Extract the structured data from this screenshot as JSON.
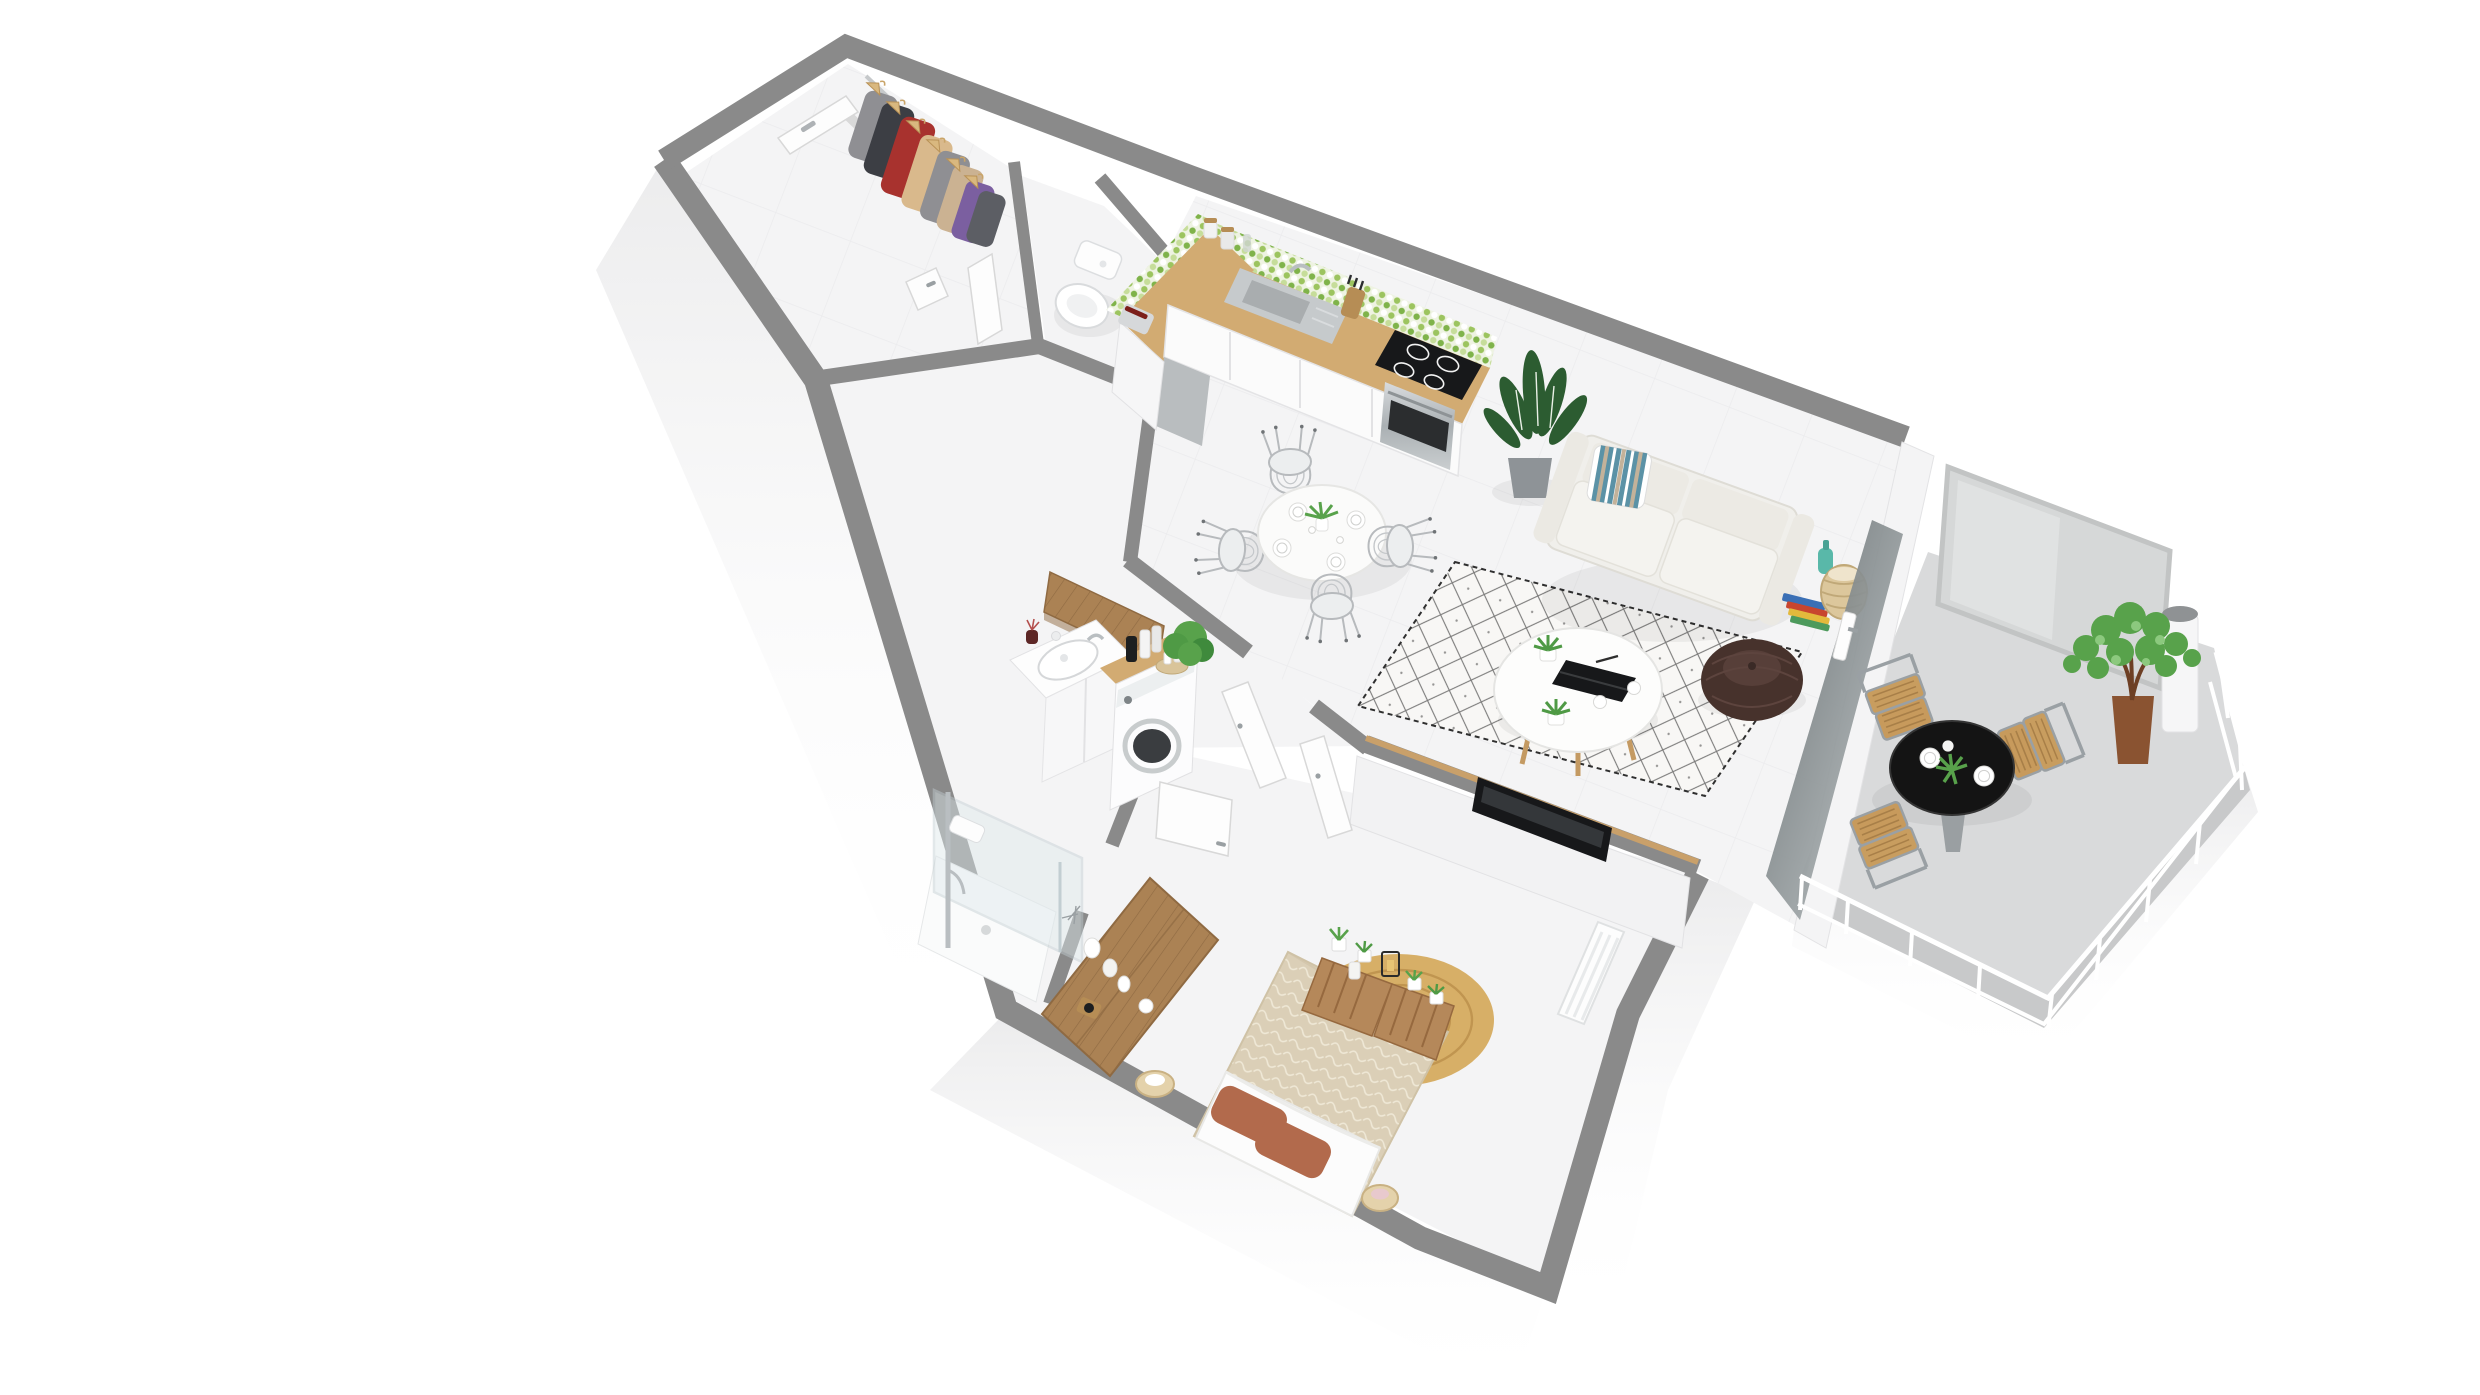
{
  "meta": {
    "type": "3d-floorplan-render",
    "description": "Isometric 3D rendering of a one-bedroom apartment floor plan with balcony, no text labels visible",
    "background": "#ffffff"
  },
  "palette": {
    "bg": "#ffffff",
    "wallTop": "#8a8a8a",
    "wallFace": "#f7f7f8",
    "floor": "#f4f4f5",
    "floorBalcony": "#d9dadb",
    "slabEdge": "#c8c9ca",
    "wood": "#d2ab72",
    "woodDark": "#b68d55",
    "dresserWood": "#ab8254",
    "crateWood": "#b5885a",
    "jute": "#d7af67",
    "juteRing": "#c09550",
    "duvet": "#dbcfb7",
    "sheet": "#fcfcfc",
    "pillowRust": "#b26a4c",
    "sofa": "#f0efeb",
    "pouf": "#47322c",
    "rugBase": "#f8f7f5",
    "rugPattern": "#343434",
    "plantGreen": "#58a24b",
    "plantDark": "#2c5c31",
    "potBrown": "#8a5331",
    "potGray": "#8e9397",
    "mosaicGreen1": "#9cc45f",
    "mosaicGreen2": "#c6dd9a",
    "mosaicGreen3": "#7fb34a",
    "steel": "#c6cacc",
    "black": "#17181a",
    "chrome": "#b9bec1",
    "railWhite": "#ffffff",
    "frost": "#d6d8d8",
    "frostFrame": "#c2c4c4",
    "glassDark": "#63696c",
    "glassLight": "#b9bfc1",
    "tealVase": "#59b8a9",
    "stripeTeal": "#49869c",
    "stripeTan": "#c3b29a",
    "garmentRed": "#a8322e",
    "garmentPurple": "#7b5fa0",
    "garmentGray": "#8f8f93",
    "garmentCharcoal": "#3c3e44",
    "garmentTan": "#d9b98c"
  },
  "rooms": [
    {
      "id": "entry-hall",
      "label": "Entrance hall",
      "furniture": [
        "open-closet-with-hangers",
        "entry-door"
      ]
    },
    {
      "id": "wc",
      "label": "Toilet room",
      "furniture": [
        "toilet"
      ]
    },
    {
      "id": "kitchen",
      "label": "Kitchen",
      "furniture": [
        "mosaic-backsplash",
        "wood-countertop",
        "sink",
        "induction-cooktop",
        "oven",
        "toaster",
        "storage-jars",
        "knife-block",
        "potted-plant"
      ]
    },
    {
      "id": "dining",
      "label": "Dining area",
      "furniture": [
        "round-table",
        "wire-chairs-x4",
        "table-setting",
        "plant-centerpiece"
      ]
    },
    {
      "id": "living",
      "label": "Living room",
      "furniture": [
        "two-seat-sofa",
        "striped-pillow",
        "berber-rug",
        "round-coffee-table",
        "laptop",
        "aloe-pots",
        "knit-pouf",
        "floor-plant",
        "book-stack",
        "teal-vase",
        "wicker-basket",
        "tv-half-wall",
        "flatscreen-tv"
      ]
    },
    {
      "id": "balcony",
      "label": "Balcony",
      "furniture": [
        "frosted-privacy-screen",
        "flue-cylinder",
        "ficus-plant",
        "black-bistro-table",
        "teak-chairs-x3",
        "white-railing"
      ]
    },
    {
      "id": "bathroom",
      "label": "Bathroom",
      "furniture": [
        "vanity-sink",
        "wall-cabinet",
        "washing-machine",
        "countertop-bottles",
        "green-bush",
        "walk-in-shower",
        "glass-partition"
      ]
    },
    {
      "id": "bedroom",
      "label": "Bedroom",
      "furniture": [
        "double-bed",
        "rust-pillows",
        "crate-headboard-shelf",
        "jute-round-rug",
        "wood-dresser",
        "radiator",
        "bedside-baskets"
      ]
    }
  ],
  "doors": [
    "entry-door",
    "hall-door",
    "wc-door",
    "bathroom-door-left",
    "bathroom-door-right",
    "bedroom-door",
    "balcony-glazed-door"
  ]
}
